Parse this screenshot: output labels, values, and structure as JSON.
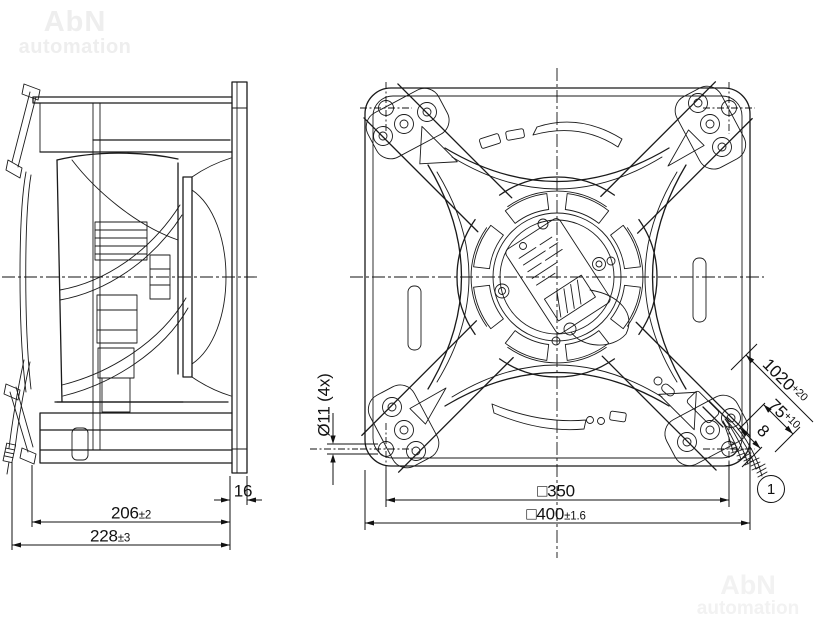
{
  "watermark": {
    "line1": "AbN",
    "line2": "automation"
  },
  "side_view": {
    "dim_206": {
      "value": "206",
      "tol": "±2"
    },
    "dim_228": {
      "value": "228",
      "tol": "±3"
    },
    "dim_16": {
      "value": "16"
    }
  },
  "front_view": {
    "dim_350": {
      "value": "□350"
    },
    "dim_400": {
      "value": "□400",
      "tol": "±1.6"
    },
    "dim_mounting_holes": {
      "value": "Ø11 (4x)"
    },
    "dim_cable_length": {
      "value": "1020",
      "tol": "+20"
    },
    "dim_strip_length": {
      "value": "75",
      "tol": "+10"
    },
    "dim_8": {
      "value": "8"
    },
    "callout_1": {
      "value": "1"
    }
  },
  "colors": {
    "line": "#1a1a1a",
    "dimension_text": "#111111",
    "watermark": "#efefef",
    "background": "#ffffff"
  }
}
